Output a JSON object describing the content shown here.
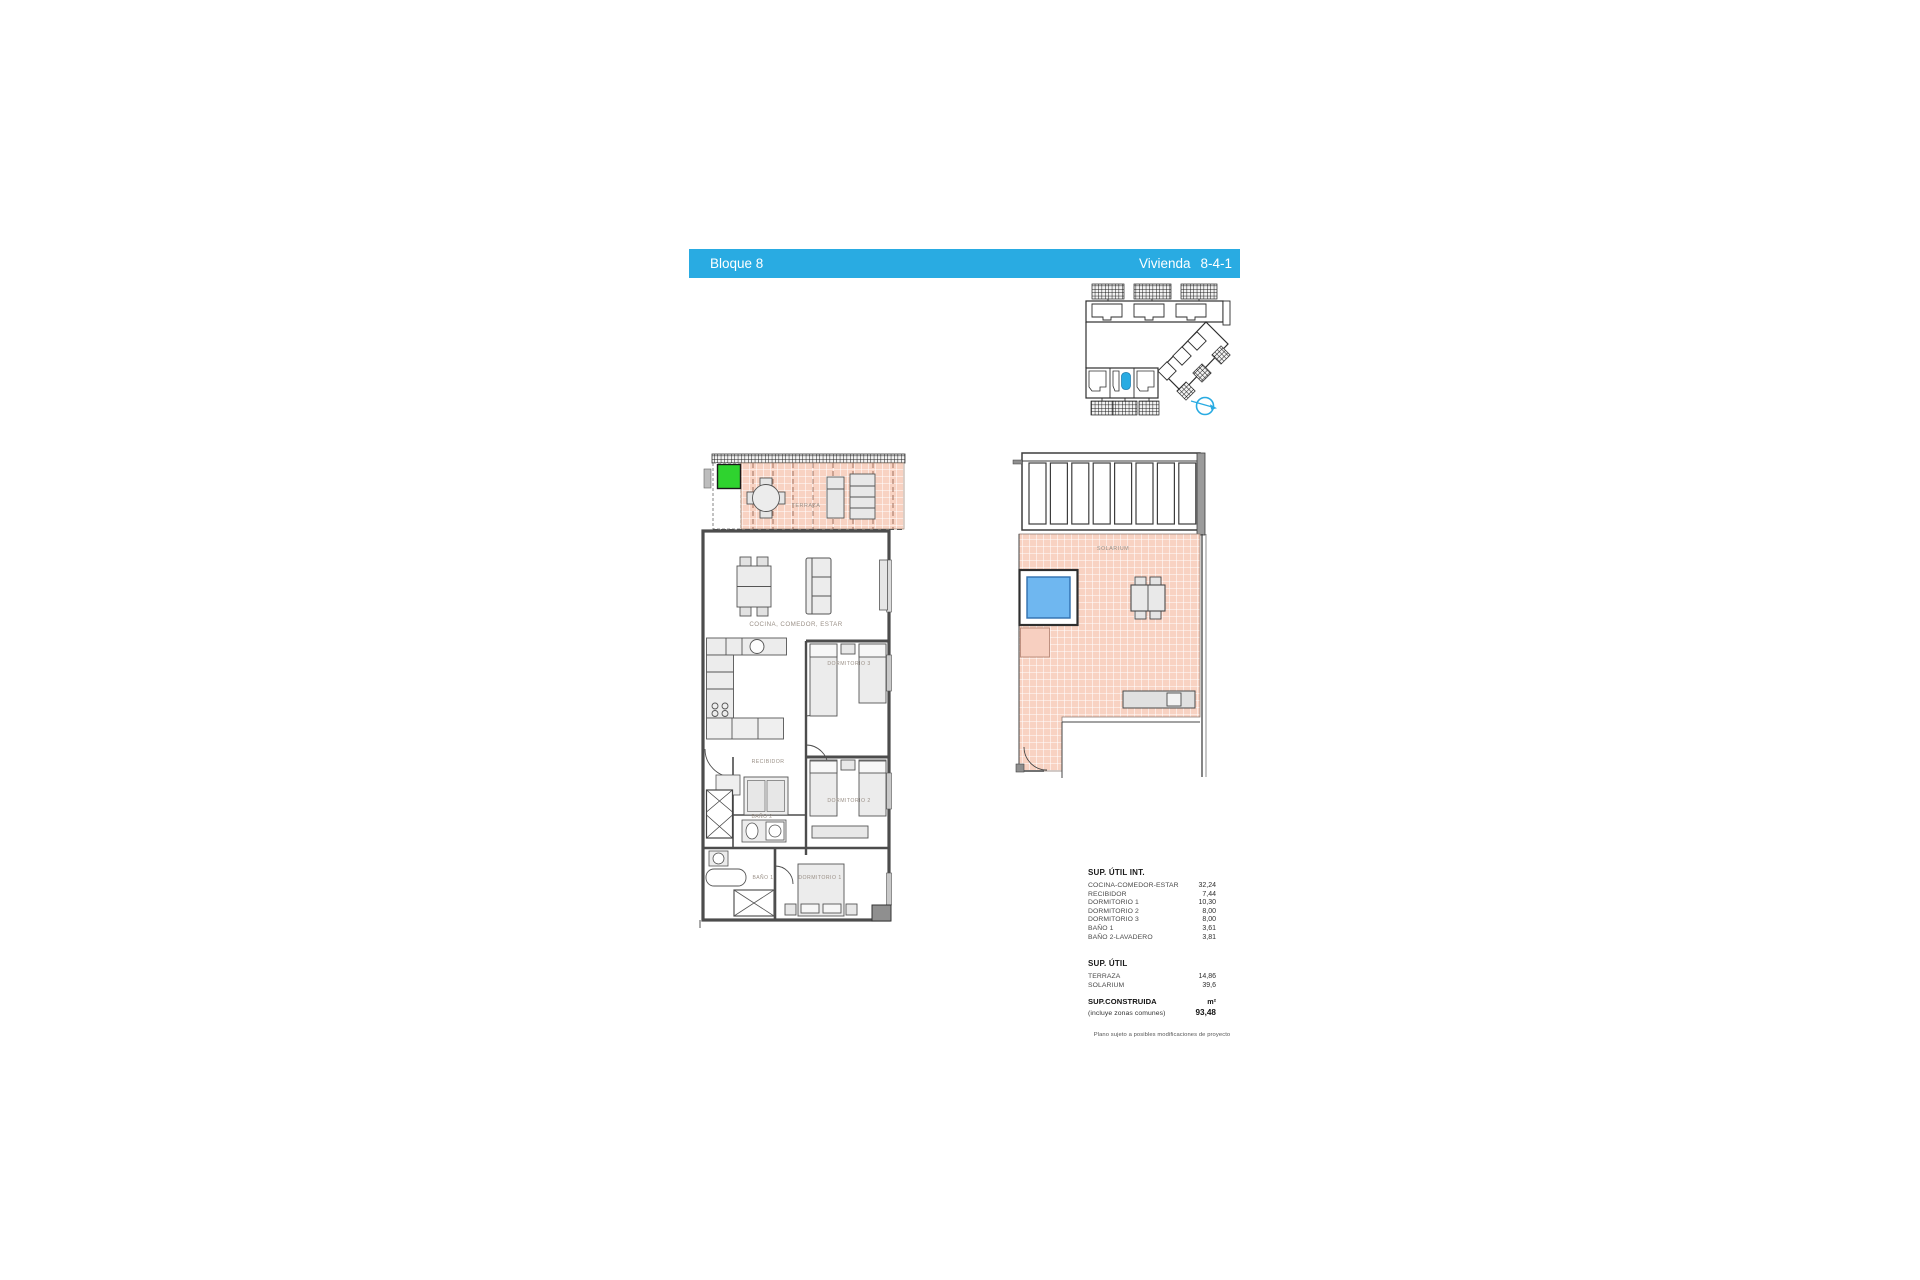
{
  "header": {
    "left_label": "Bloque 8",
    "right_label_name": "Vivienda",
    "right_label_value": "8-4-1"
  },
  "key_plan": {
    "compass_icon": "north-arrow-icon",
    "highlight_note": "unit-location-highlight"
  },
  "floor_plan": {
    "labels": {
      "terraza": "TERRAZA",
      "cocina": "COCINA, COMEDOR, ESTAR",
      "dormitorio3": "DORMITORIO 3",
      "recibidor": "RECIBIDOR",
      "dormitorio2": "DORMITORIO 2",
      "bano2": "BAÑO 2",
      "bano1": "BAÑO 1",
      "dormitorio1": "DORMITORIO 1"
    }
  },
  "solarium_plan": {
    "label": "SOLARIUM"
  },
  "areas": {
    "util_int_title": "SUP. ÚTIL INT.",
    "util_int_rows": [
      {
        "label": "COCINA-COMEDOR-ESTAR",
        "value": "32,24"
      },
      {
        "label": "RECIBIDOR",
        "value": "7,44"
      },
      {
        "label": "DORMITORIO 1",
        "value": "10,30"
      },
      {
        "label": "DORMITORIO 2",
        "value": "8,00"
      },
      {
        "label": "DORMITORIO 3",
        "value": "8,00"
      },
      {
        "label": "BAÑO 1",
        "value": "3,61"
      },
      {
        "label": "BAÑO 2-LAVADERO",
        "value": "3,81"
      }
    ],
    "util_title": "SUP. ÚTIL",
    "util_rows": [
      {
        "label": "TERRAZA",
        "value": "14,86"
      },
      {
        "label": "SOLARIUM",
        "value": "39,6"
      }
    ],
    "construida_title": "SUP.CONSTRUIDA",
    "construida_unit": "m²",
    "construida_sub": "(incluye zonas comunes)",
    "construida_value": "93,48"
  },
  "footnote": "Plano sujeto a posibles modificaciones de proyecto",
  "colors": {
    "accent_blue": "#29ABE2",
    "floor_salmon": "#F8D2C2",
    "pool_blue": "#6FB7F0",
    "highlight_green": "#2FD32F",
    "wall_gray": "#4C4C4C"
  }
}
